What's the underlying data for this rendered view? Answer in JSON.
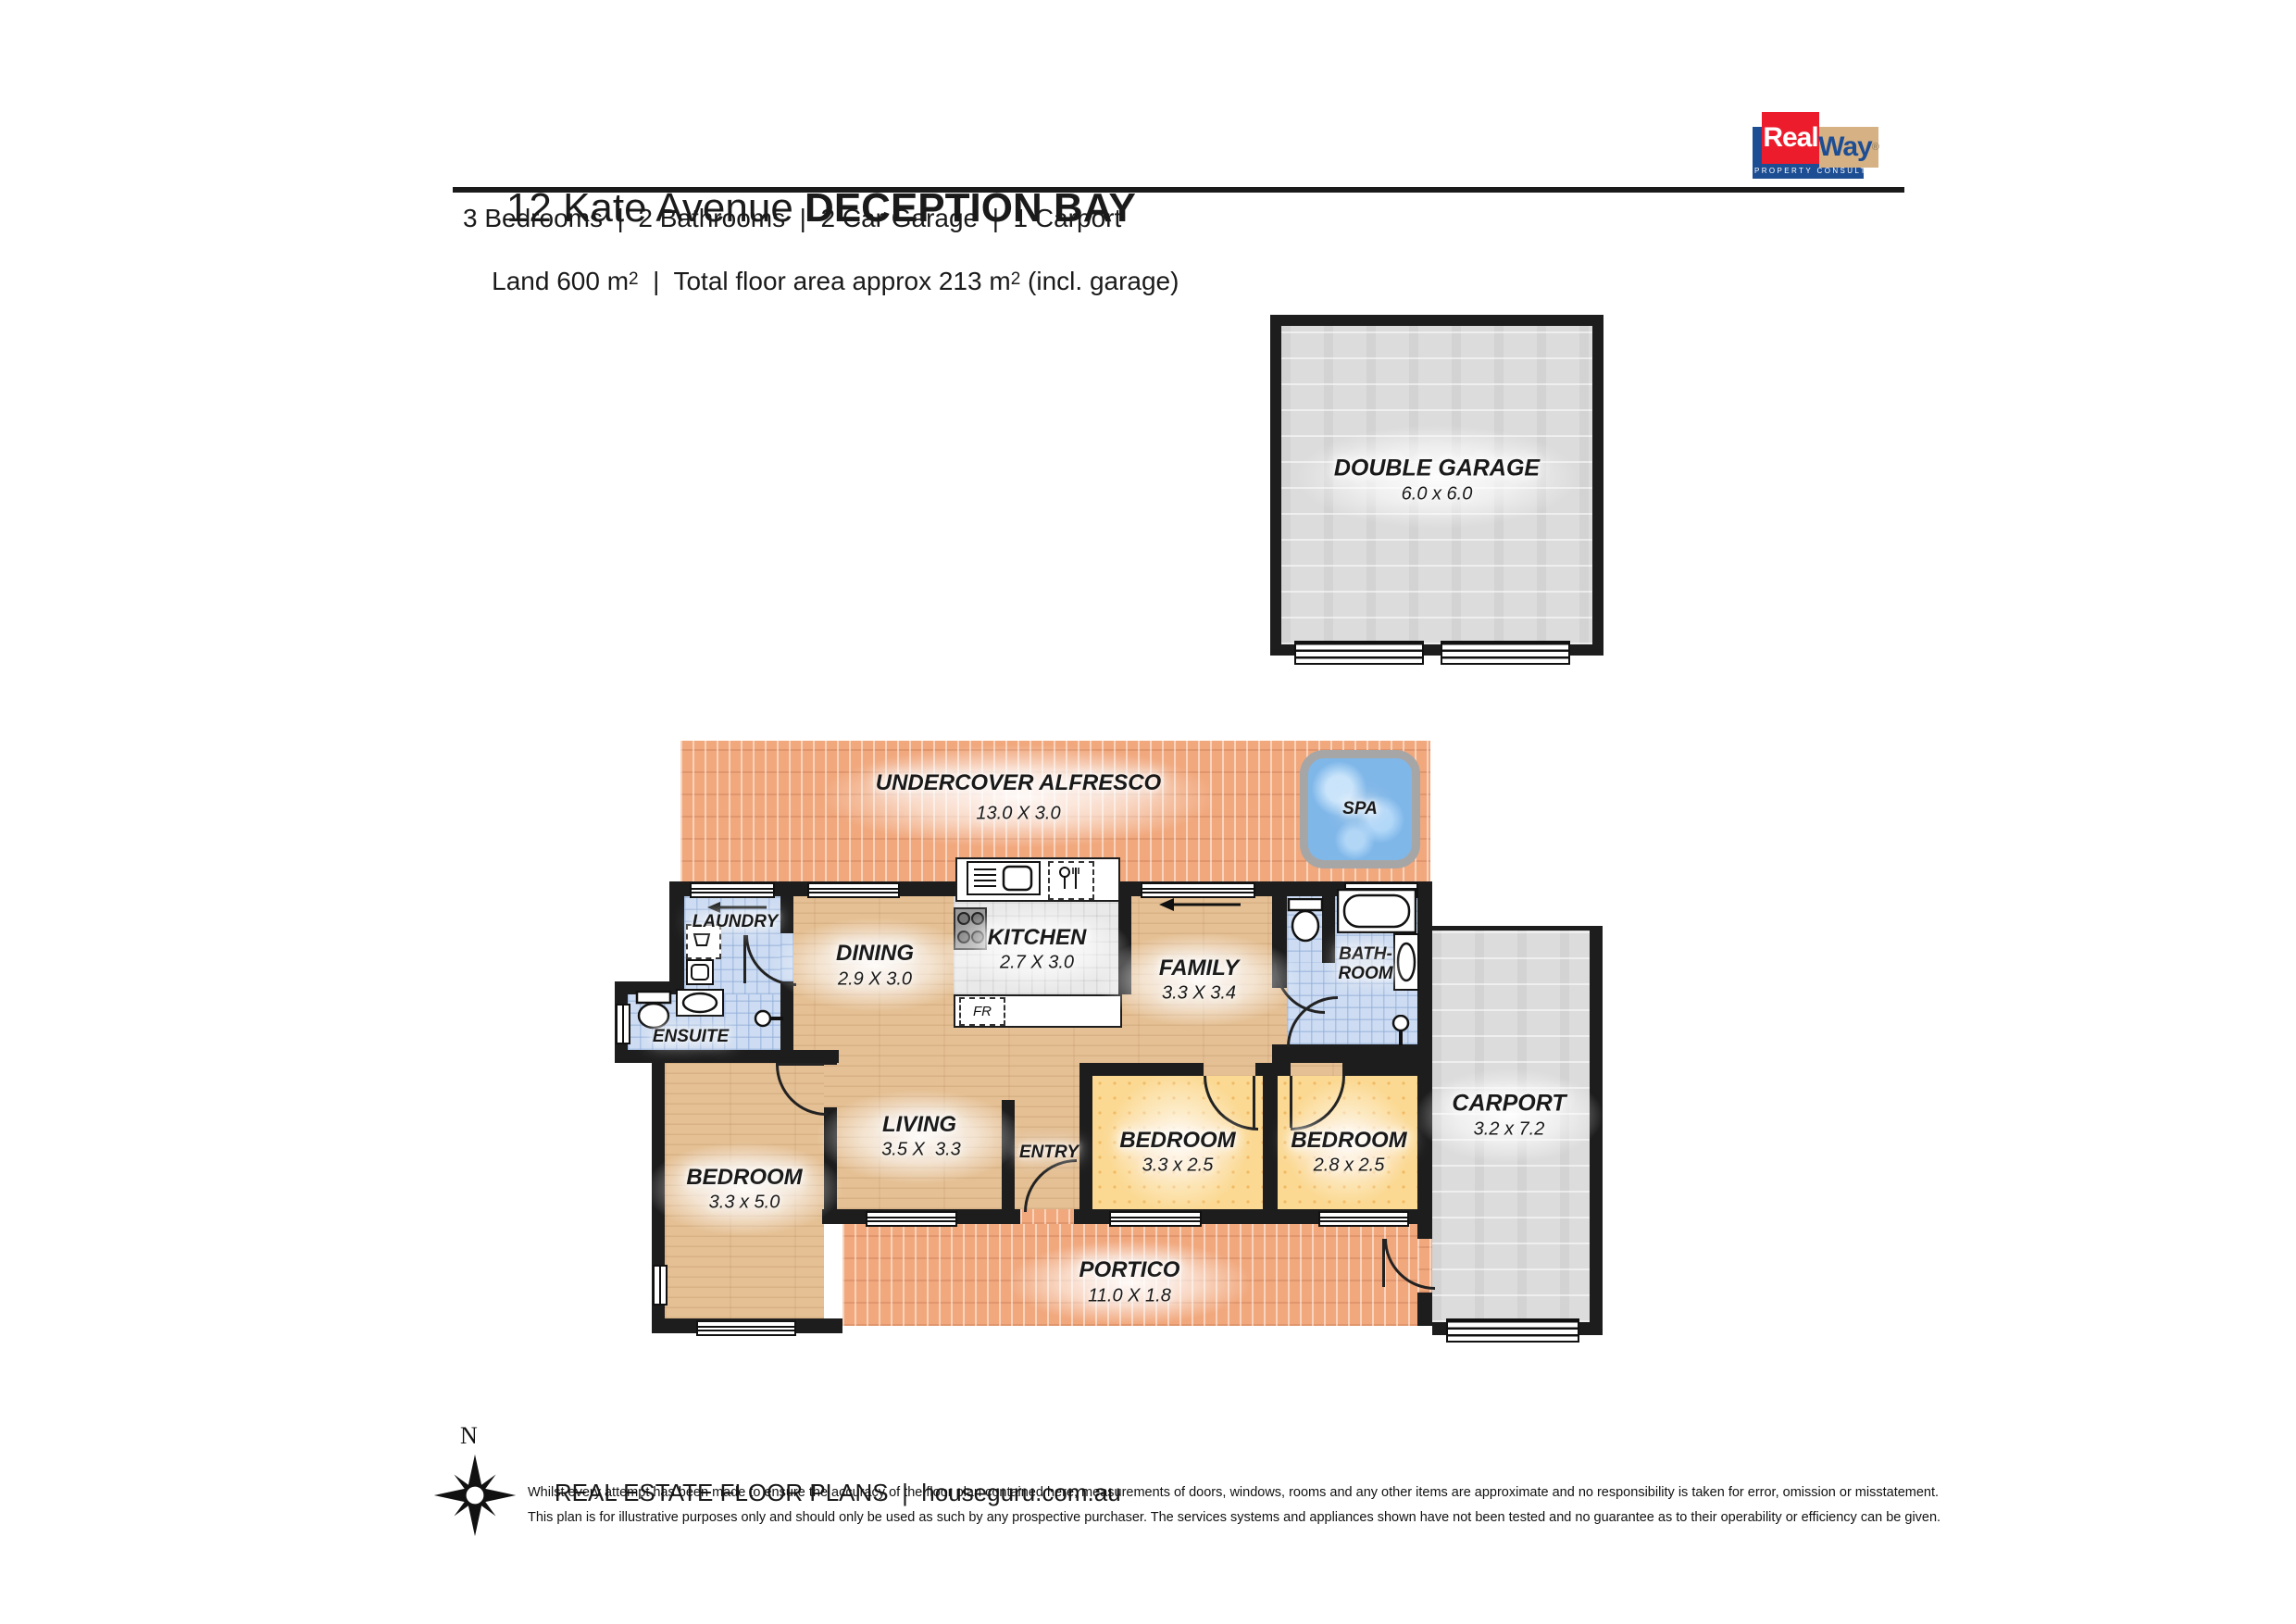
{
  "header": {
    "street": "12 Kate Avenue ",
    "suburb": "DECEPTION BAY",
    "features": "3 Bedrooms  |  2 Bathrooms  |  2 Car Garage  |  1 Carport",
    "land": {
      "prefix": "Land 600 m",
      "sup1": "2",
      "middle": "  |  Total floor area approx 213 m",
      "sup2": "2",
      "suffix": " (incl. garage)"
    }
  },
  "logo": {
    "real": "Real",
    "way": "Way",
    "registered": "®",
    "tagline": "PROPERTY CONSULTANTS"
  },
  "rooms": {
    "garage": {
      "name": "DOUBLE GARAGE",
      "dims": "6.0 x 6.0"
    },
    "alfresco": {
      "name": "UNDERCOVER ALFRESCO",
      "dims": "13.0 X 3.0"
    },
    "spa": {
      "name": "SPA"
    },
    "laundry": {
      "name": "LAUNDRY"
    },
    "ensuite": {
      "name": "ENSUITE"
    },
    "dining": {
      "name": "DINING",
      "dims": "2.9 X 3.0"
    },
    "kitchen": {
      "name": "KITCHEN",
      "dims": "2.7 X 3.0"
    },
    "family": {
      "name": "FAMILY",
      "dims": "3.3 X 3.4"
    },
    "bathroom": {
      "name_line1": "BATH-",
      "name_line2": "ROOM"
    },
    "living": {
      "name": "LIVING",
      "dims": "3.5 X  3.3"
    },
    "entry": {
      "name": "ENTRY"
    },
    "bedroom1": {
      "name": "BEDROOM",
      "dims": "3.3 x 2.5"
    },
    "bedroom2": {
      "name": "BEDROOM",
      "dims": "2.8 x 2.5"
    },
    "bedroom_master": {
      "name": "BEDROOM",
      "dims": "3.3 x 5.0"
    },
    "portico": {
      "name": "PORTICO",
      "dims": "11.0 X 1.8"
    },
    "carport": {
      "name": "CARPORT",
      "dims": "3.2 x 7.2"
    },
    "fridge": {
      "label": "FR"
    }
  },
  "compass": {
    "north": "N"
  },
  "footer": {
    "brand": "REAL ESTATE FLOOR PLANS",
    "separator": "  |  ",
    "website": "houseguru.com.au",
    "disclaimer1": "Whilst every attempt has been made to ensure the accuracy of the floor plan contained here, measurements of doors, windows, rooms and any other items are approximate and no responsibility is taken for error, omission or misstatement.",
    "disclaimer2": "This plan is for illustrative purposes only and should only be used as such by any prospective purchaser. The services systems and appliances shown have not been tested and no guarantee as to their operability or efficiency can be given."
  },
  "colors": {
    "wall": "#1d1d1d",
    "wood": "#e5c094",
    "wet_area_blue": "#cddcf2",
    "kitchen_gray": "#e9e9e9",
    "brick_orange": "#f1a87d",
    "bedroom_yellow": "#fbd993",
    "concrete_gray": "#dcdcdc",
    "spa_water": "#7fb7e9",
    "logo_red": "#ec1c2d",
    "logo_blue": "#1d4e93",
    "logo_tan": "#d6b184"
  }
}
